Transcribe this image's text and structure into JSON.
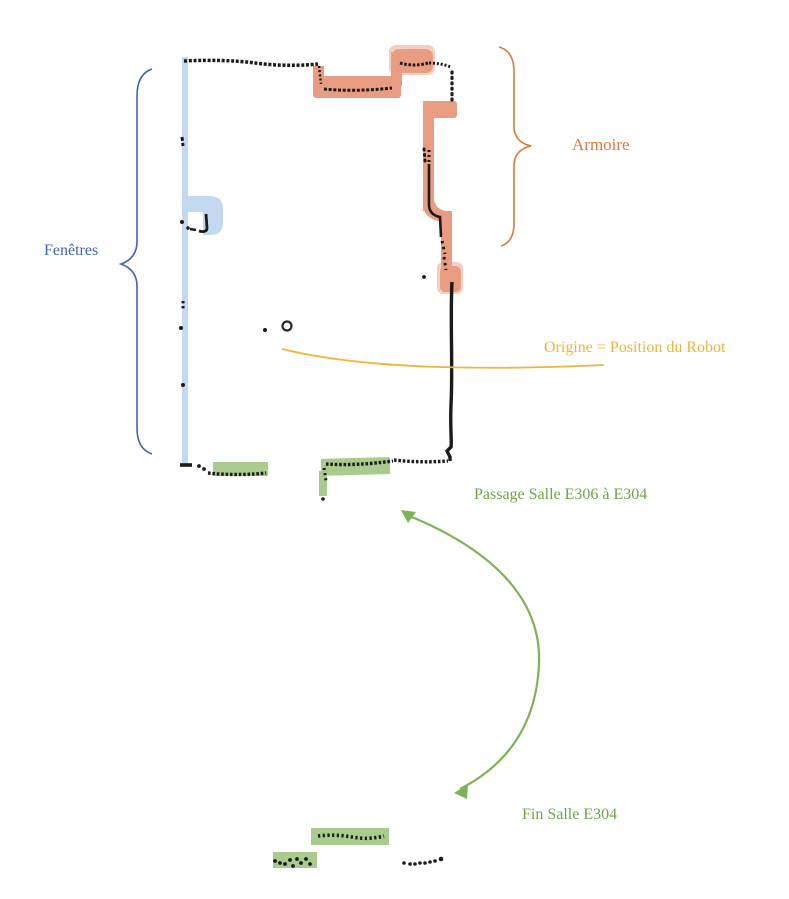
{
  "annotations": {
    "fenetres": {
      "label": "Fenêtres",
      "color": "#3F63B5"
    },
    "armoire": {
      "label": "Armoire",
      "color": "#E0793A"
    },
    "origine": {
      "label": "Origine = Position du Robot",
      "color": "#F2B33D"
    },
    "passage": {
      "label": "Passage Salle E306 à E304",
      "color": "#6BA547"
    },
    "fin_salle": {
      "label": "Fin Salle E304",
      "color": "#6BA547"
    }
  },
  "highlighted_regions": {
    "windows_highlight": "#C3D9EF",
    "cabinet_highlight": "#E89D82",
    "passage_highlight": "#AACB8E"
  },
  "map": {
    "wall_point_color": "#1B1B1B",
    "origin_marker": "circle-outline",
    "arrow_color": "#7CB356"
  }
}
